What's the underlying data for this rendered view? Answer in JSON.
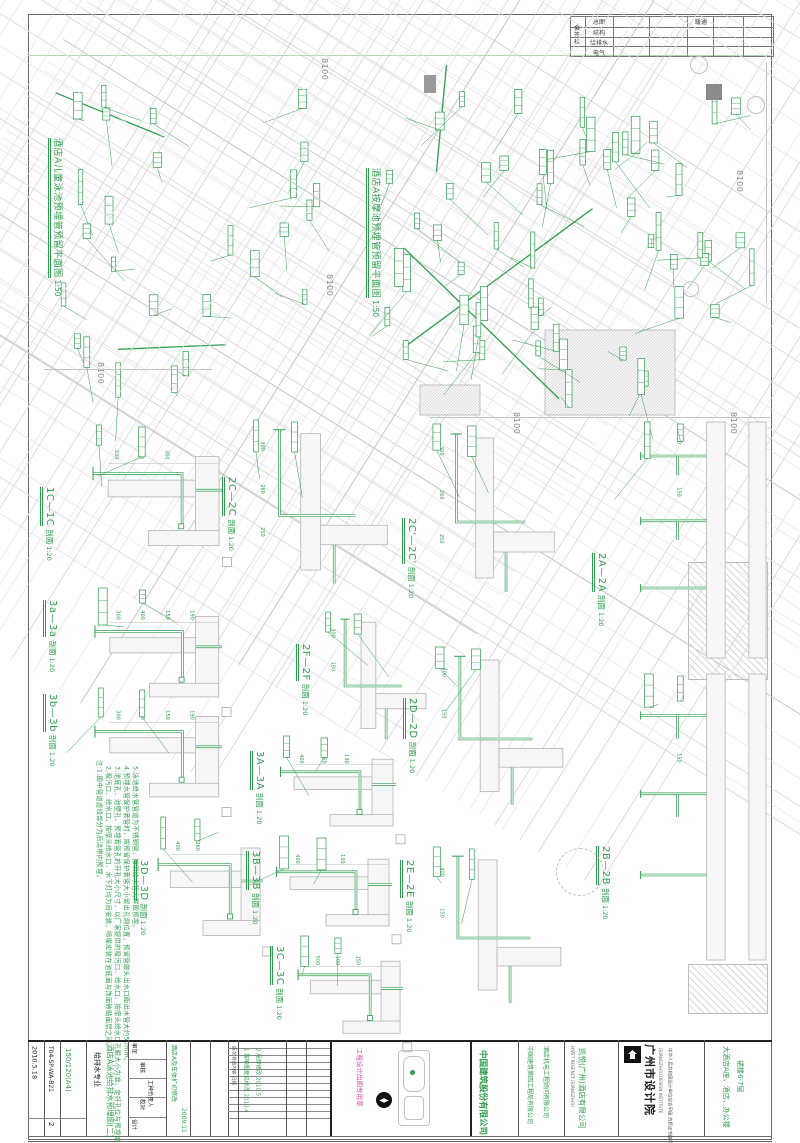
{
  "colors": {
    "green": "#2f9e4e",
    "gray_line": "#c9c9c9",
    "seal_magenta": "#cf4f9f"
  },
  "signature_table": {
    "title": "会签栏",
    "rows": [
      "总图",
      "结构",
      "给排水",
      "电气"
    ],
    "mid_label": "暖通"
  },
  "axes": {
    "dim": "8100"
  },
  "plans": [
    {
      "title": "酒店A儿童泳池预埋管预留平面图",
      "scale": "1:50"
    },
    {
      "title": "酒店A按摩池预埋管预留平面图",
      "scale": "1:50"
    }
  ],
  "sections": [
    {
      "name": "1C—1C",
      "type": "剖面",
      "scale": "1:20",
      "dims": [
        "230",
        "275",
        "300"
      ]
    },
    {
      "name": "2C—2C",
      "type": "剖面",
      "scale": "1:20",
      "dims": [
        "300",
        "260",
        "250"
      ]
    },
    {
      "name": "2C'—2C'",
      "type": "剖面",
      "scale": "1:20",
      "dims": [
        "300",
        "260",
        "250"
      ]
    },
    {
      "name": "2A—2A",
      "type": "剖面",
      "scale": "1:20",
      "dims": [
        "500",
        "150"
      ]
    },
    {
      "name": "3a—3a",
      "type": "剖面",
      "scale": "1:20",
      "dims": [
        "300",
        "400",
        "150",
        "190"
      ]
    },
    {
      "name": "2F—2F",
      "type": "剖面",
      "scale": "1:20",
      "dims": [
        "300",
        "150"
      ]
    },
    {
      "name": "3b—3b",
      "type": "剖面",
      "scale": "1:20",
      "dims": [
        "300",
        "400",
        "150",
        "190"
      ]
    },
    {
      "name": "2D—2D",
      "type": "剖面",
      "scale": "1:20",
      "dims": [
        "400",
        "150"
      ]
    },
    {
      "name": "3A—3A",
      "type": "剖面",
      "scale": "1:20",
      "dims": [
        "400",
        "150",
        "190"
      ]
    },
    {
      "name": "2B—2B",
      "type": "剖面",
      "scale": "1:20",
      "dims": [
        "500",
        "150"
      ]
    },
    {
      "name": "3D—3D",
      "type": "剖面",
      "scale": "1:20",
      "dims": [
        "400",
        "260"
      ]
    },
    {
      "name": "3B—3B",
      "type": "剖面",
      "scale": "1:20",
      "dims": [
        "400",
        "150",
        "190"
      ]
    },
    {
      "name": "2E—2E",
      "type": "剖面",
      "scale": "1:20",
      "dims": [
        "400",
        "150"
      ]
    },
    {
      "name": "3C—3C",
      "type": "剖面",
      "scale": "1:20",
      "dims": [
        "500",
        "100",
        "150"
      ]
    }
  ],
  "notes": {
    "lines": [
      "注:1.图中管道虚线部分为后浇带内预埋。",
      "2.吸污口、给水口、按摩头给水口、水下灯均为后安装，喷嘴应装在池底面与饰面砖贴面层之间。",
      "3.池底孔、池壁孔、预埋套管孔的开孔大小尺寸，以厂家提供的吸污口、给水口、按摩头给水口孔眼大小为准，定好孔位与预埋端头法兰后连接。",
      "4.预埋水管保护套管时，按预留保护套管大小留出孔洞位置，预留管端头出水口距出水管大约50mm。",
      "5.泳池给水管管道为不锈钢管，按照给水管大样图预埋。"
    ]
  },
  "titleblock": {
    "date": "2010.5.18",
    "docno": "T04-SP-WA-B21",
    "sheetno": "150/120(A4)",
    "version": "2",
    "discipline": "给排水专业",
    "drawing_title": "酒店A泳池给排水预埋图(二)",
    "staff": [
      "审定",
      "审核",
      "工种负责人",
      "校对",
      "设计"
    ],
    "revision_note": "酒店A及车体扩初修改",
    "revision_date": "2009.11",
    "revisions": {
      "headers": "版次 修改内容 日期",
      "rows": [
        "1 按审图意见修改 2010.4",
        "2 局部修改 2010.5"
      ]
    },
    "seal": "工程设计出图专用章",
    "north_glyph": "◀▶",
    "contractor": "中国建筑股份有限公司",
    "contractor2": "中国建筑第四工程局有限公司",
    "mep_consultant": "酒店机电工程顾问有限公司",
    "client_en": "HYATT REGENCY GUANGZHOU",
    "client": "凯悦(广州)酒店有限公司",
    "institute": "广州市设计院",
    "institute_en": "GUANGZHOU DESIGN INSTITUTE",
    "institute_cert": "中华人民共和国设计单位综合甲级 资质证书编号:120001甲",
    "project": "大酒店A座、酒店、办公楼",
    "project2": "裙楼6-7层"
  }
}
